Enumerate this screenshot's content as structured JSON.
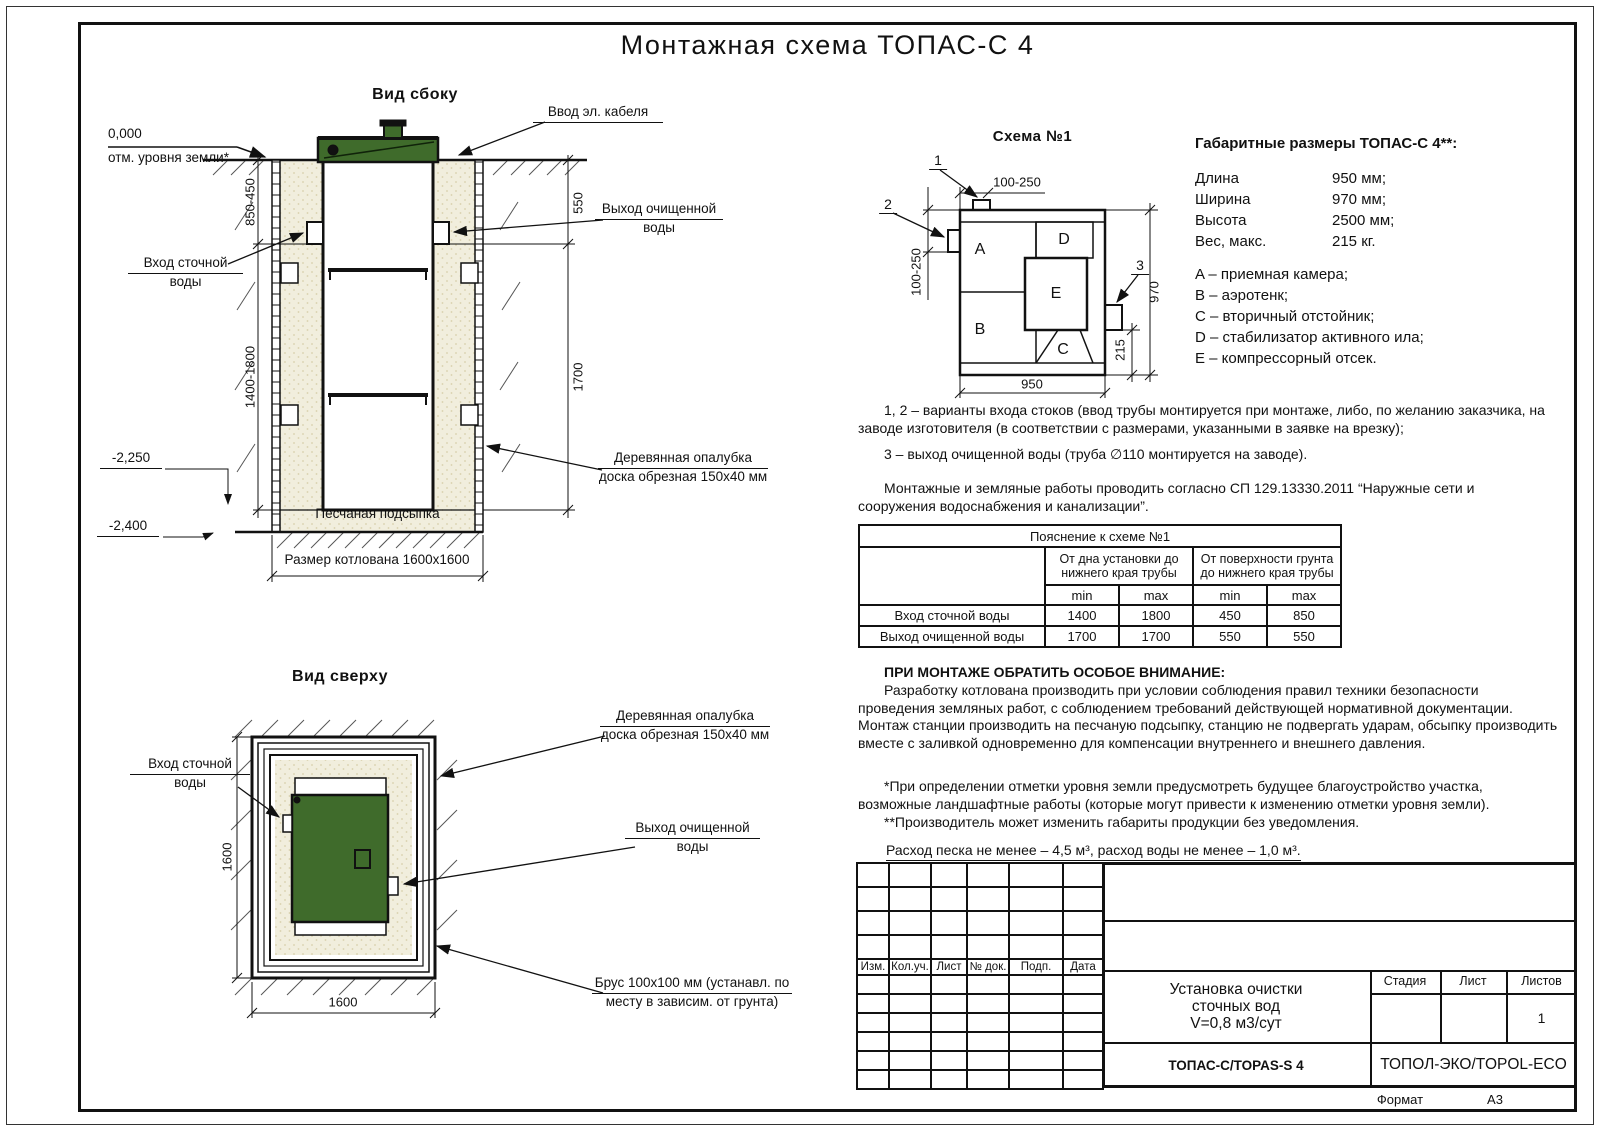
{
  "doc": {
    "title": "Монтажная схема ТОПАС-С 4",
    "format_label": "Формат",
    "format_value": "А3"
  },
  "colors": {
    "green": "#3f6b2b",
    "sand": "#f1eedd",
    "line": "#111111"
  },
  "side_view": {
    "title": "Вид сбоку",
    "zero_mark": "0,000",
    "ground_note": "отм. уровня земли*",
    "cable_label": "Ввод эл. кабеля",
    "inlet_line1": "Вход сточной",
    "inlet_line2": "воды",
    "outlet_line1": "Выход очищенной",
    "outlet_line2": "воды",
    "formwork_line1": "Деревянная опалубка",
    "formwork_line2": "доска обрезная 150х40 мм",
    "sand_label": "Песчаная подсыпка",
    "pit_size_label": "Размер котлована 1600х1600",
    "dim_depth_top": "850-450",
    "dim_depth_bottom": "1400-1800",
    "dim_right_top": "550",
    "dim_right_bottom": "1700",
    "elev_sand": "-2,250",
    "elev_bottom": "-2,400"
  },
  "top_view": {
    "title": "Вид сверху",
    "inlet_line1": "Вход сточной",
    "inlet_line2": "воды",
    "outlet_line1": "Выход очищенной",
    "outlet_line2": "воды",
    "formwork_line1": "Деревянная опалубка",
    "formwork_line2": "доска обрезная 150х40 мм",
    "beam_line1": "Брус 100х100 мм (устанавл. по",
    "beam_line2": "месту в зависим. от грунта)",
    "dim_left": "1600",
    "dim_bottom": "1600"
  },
  "schema": {
    "title": "Схема №1",
    "compartments": [
      "A",
      "B",
      "C",
      "D",
      "E"
    ],
    "callout_1": "1",
    "callout_2": "2",
    "callout_3": "3",
    "dim_top": "100-250",
    "dim_left": "100-250",
    "dim_right": "970",
    "dim_inner": "215",
    "dim_bottom": "950"
  },
  "specs": {
    "title": "Габаритные размеры ТОПАС-С 4**:",
    "rows": [
      {
        "label": "Длина",
        "value": "950 мм;"
      },
      {
        "label": "Ширина",
        "value": "970 мм;"
      },
      {
        "label": "Высота",
        "value": "2500 мм;"
      },
      {
        "label": "Вес, макс.",
        "value": "215 кг."
      }
    ],
    "legend": [
      "A – приемная камера;",
      "B – аэротенк;",
      "C – вторичный отстойник;",
      "D – стабилизатор активного ила;",
      "E – компрессорный отсек."
    ]
  },
  "notes": {
    "p1": "1, 2 – варианты входа стоков (ввод трубы монтируется при монтаже, либо, по желанию заказчика, на заводе изготовителя (в соответствии с размерами, указанными в заявке на врезку);",
    "p2": "3 – выход очищенной воды (труба ∅110 монтируется на заводе).",
    "p3": "Монтажные и земляные работы проводить согласно СП 129.13330.2011 “Наружные сети и сооружения водоснабжения и канализации”."
  },
  "explain_table": {
    "title": "Пояснение к схеме №1",
    "group1": "От дна установки до нижнего края трубы",
    "group2": "От поверхности грунта до нижнего края трубы",
    "min": "min",
    "max": "max",
    "rows": [
      {
        "label": "Вход сточной воды",
        "c1": "1400",
        "c2": "1800",
        "c3": "450",
        "c4": "850"
      },
      {
        "label": "Выход очищенной воды",
        "c1": "1700",
        "c2": "1700",
        "c3": "550",
        "c4": "550"
      }
    ]
  },
  "attention": {
    "title": "ПРИ МОНТАЖЕ ОБРАТИТЬ ОСОБОЕ ВНИМАНИЕ:",
    "body": "Разработку котлована производить при условии соблюдения правил техники безопасности проведения земляных работ, с соблюдением требований действующей нормативной документации. Монтаж станции производить на песчаную подсыпку, станцию не подвергать ударам, обсыпку производить вместе с заливкой одновременно для компенсации внутреннего и внешнего давления."
  },
  "footnotes": {
    "f1": "*При определении отметки уровня земли предусмотреть будущее благоустройство участка, возможные ландшафтные работы (которые могут привести к изменению отметки уровня земли).",
    "f2": "**Производитель может изменить габариты продукции без уведомления.",
    "consumption": "Расход песка не менее – 4,5 м³, расход воды не менее – 1,0 м³."
  },
  "title_block": {
    "cols": [
      "Изм.",
      "Кол.уч.",
      "Лист",
      "№ док.",
      "Подп.",
      "Дата"
    ],
    "doc_line1": "Установка очистки",
    "doc_line2": "сточных вод",
    "doc_line3": "V=0,8 м3/сут",
    "stage": "Стадия",
    "sheet": "Лист",
    "sheets": "Листов",
    "sheets_value": "1",
    "model": "ТОПАС-С/TOPAS-S 4",
    "company": "ТОПОЛ-ЭКО/TOPOL-ECO"
  }
}
